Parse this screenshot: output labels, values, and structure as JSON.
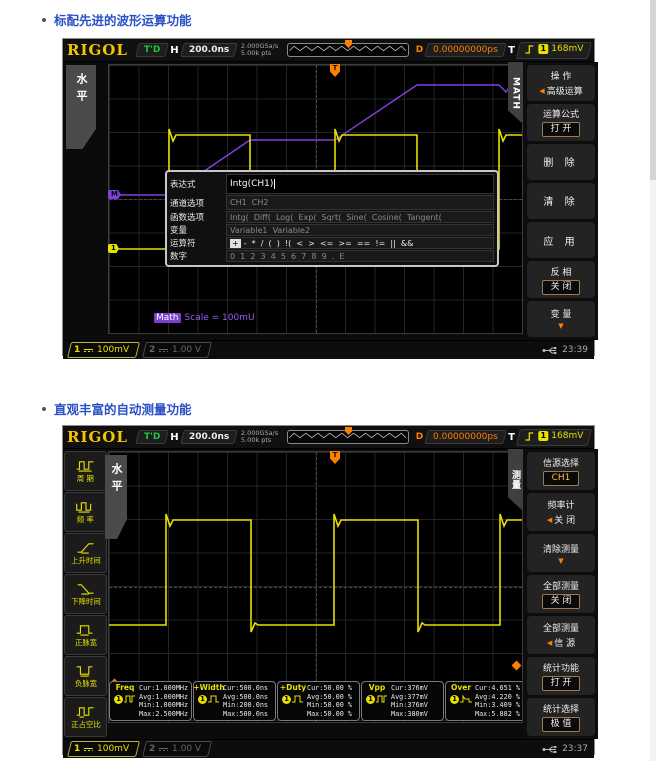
{
  "sections": [
    {
      "title": "标配先进的波形运算功能"
    },
    {
      "title": "直观丰富的自动测量功能"
    }
  ],
  "glyphs": {
    "left_arrow": "◀",
    "down_arrow": "▼",
    "trig_t": "T"
  },
  "topbar": {
    "brand": "RIGOL",
    "trig_status": "T'D",
    "h_label": "H",
    "timebase": "200.0ns",
    "sample_rate": "2.000GSa/s",
    "mem_depth": "5.00k pts",
    "d_label": "D",
    "delay": "0.00000000ps",
    "t_label": "T",
    "trig_channel": "1",
    "trig_level": "168mV"
  },
  "bottombar": {
    "ch1_num": "1",
    "ch1_scale": "100mV",
    "ch2_num": "2",
    "ch2_scale": "1.00 V"
  },
  "scope1": {
    "time": "23:39",
    "left_tab": "水平",
    "right_tab": "MATH",
    "marker_math": "M",
    "marker_ch1": "1",
    "math_scale_chip": "Math",
    "math_scale_text": "Scale = 100mU",
    "menu": [
      {
        "label": "操  作",
        "value": "高级运算"
      },
      {
        "label": "运算公式",
        "value": "打  开"
      },
      {
        "value": "删  除"
      },
      {
        "value": "清  除"
      },
      {
        "value": "应  用"
      },
      {
        "label": "反  相",
        "value": "关  闭"
      },
      {
        "label": "变  量"
      }
    ],
    "dialog": {
      "rows": [
        {
          "label": "表达式",
          "value": "Intg(CH1)"
        },
        {
          "label": "通道选项",
          "value": "CH1  CH2"
        },
        {
          "label": "函数选项",
          "value": "Intg(  Diff(  Log(  Exp(  Sqrt(  Sine(  Cosine(  Tangent("
        },
        {
          "label": "变量",
          "value": "Variable1  Variable2"
        },
        {
          "label": "运算符",
          "first": "+",
          "value": "-  *  /  (  )  !(  <  >  <=  >=  ==  !=  ||  &&"
        },
        {
          "label": "数字",
          "value": "0  1  2  3  4  5  6  7  8  9  .  E"
        }
      ]
    },
    "wave": {
      "ch1": "0,184 60,184 60,64 64,76 67,70 141,70 141,191 145,181 148,184 226,184 226,64 230,76 233,70 308,70 308,191 312,181 315,184 390,184 390,64 394,76 397,70 413,70",
      "math": "0,130 60,130 141,75 226,75 308,20 390,20 397,27 413,3"
    }
  },
  "scope2": {
    "time": "23:37",
    "left_tab": "水平",
    "right_tab": "测量",
    "sidebar": [
      {
        "label": "周 期"
      },
      {
        "label": "频 率"
      },
      {
        "label": "上升时间"
      },
      {
        "label": "下降时间"
      },
      {
        "label": "正脉宽"
      },
      {
        "label": "负脉宽"
      },
      {
        "label": "正占空比"
      }
    ],
    "menu": [
      {
        "label": "信源选择",
        "value": "CH1"
      },
      {
        "label": "频率计",
        "value": "关  闭"
      },
      {
        "label": "清除测量"
      },
      {
        "label": "全部测量",
        "value": "关  闭"
      },
      {
        "label": "全部测量",
        "value": "信  源"
      },
      {
        "label": "统计功能",
        "value": "打  开"
      },
      {
        "label": "统计选择",
        "value": "极  值"
      }
    ],
    "stat_labels": [
      "Cur",
      "Avg",
      "Min",
      "Max"
    ],
    "stats": [
      {
        "name": "Freq",
        "ch": "1",
        "values": [
          "1.000MHz",
          "1.000MHz",
          "1.000MHz",
          "2.500MHz"
        ]
      },
      {
        "name": "+Width",
        "ch": "1",
        "values": [
          "500.0ns",
          "500.0ns",
          "200.0ns",
          "500.0ns"
        ]
      },
      {
        "name": "+Duty",
        "ch": "1",
        "values": [
          "50.00 %",
          "50.00 %",
          "50.00 %",
          "50.00 %"
        ]
      },
      {
        "name": "Vpp",
        "ch": "1",
        "values": [
          "376mV",
          "377mV",
          "376mV",
          "380mV"
        ]
      },
      {
        "name": "Over",
        "ch": "1",
        "values": [
          "4.651 %",
          "4.220 %",
          "3.409 %",
          "5.882 %"
        ]
      }
    ],
    "wave": {
      "ch1": "0,173 57,173 57,62 61,74 64,68 142,68 142,180 146,171 149,173 225,173 225,62 229,74 232,68 309,68 309,180 313,171 316,173 391,173 391,62 395,74 398,68 413,68"
    }
  }
}
